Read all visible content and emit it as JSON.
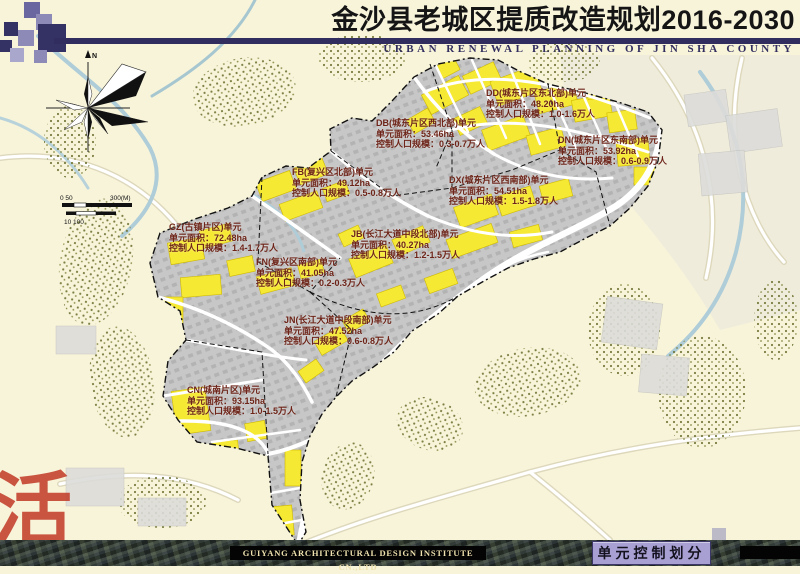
{
  "header": {
    "title": "金沙县老城区提质改造规划2016-2030",
    "subtitle": "URBAN RENEWAL PLANNING OF JIN SHA COUNTY"
  },
  "colors": {
    "accent_navy": "#312d5e",
    "highlight_yellow": "#f6e933",
    "label_text": "#6e2418",
    "tag_purple": "#a89fd2",
    "background_cream": "#f8f4da"
  },
  "compass": {
    "north_label": "N"
  },
  "scale_bar": {
    "row1_left": "0 50",
    "row1_right": "300(M)",
    "row2": "10 100"
  },
  "units": [
    {
      "id": "DD",
      "code": "DD(城东片区东北部)单元",
      "area": "单元面积：48.20ha",
      "population": "控制人口规模：1.0-1.6万人"
    },
    {
      "id": "DB",
      "code": "DB(城东片区西北部)单元",
      "area": "单元面积：53.46ha",
      "population": "控制人口规模：0.3-0.7万人"
    },
    {
      "id": "FB",
      "code": "FB(复兴区北部)单元",
      "area": "单元面积：49.12ha",
      "population": "控制人口规模：0.5-0.8万人"
    },
    {
      "id": "DX",
      "code": "DX(城东片区西南部)单元",
      "area": "单元面积：54.51ha",
      "population": "控制人口规模：1.5-1.8万人"
    },
    {
      "id": "DN",
      "code": "DN(城东片区东南部)单元",
      "area": "单元面积：53.92ha",
      "population": "控制人口规模：0.6-0.9万人"
    },
    {
      "id": "GZ",
      "code": "GZ(古镇片区)单元",
      "area": "单元面积：72.48ha",
      "population": "控制人口规模：1.4-1.7万人"
    },
    {
      "id": "FN",
      "code": "FN(复兴区南部)单元",
      "area": "单元面积：41.05ha",
      "population": "控制人口规模：0.2-0.3万人"
    },
    {
      "id": "JB",
      "code": "JB(长江大道中段北部)单元",
      "area": "单元面积：40.27ha",
      "population": "控制人口规模：1.2-1.5万人"
    },
    {
      "id": "JN",
      "code": "JN(长江大道中段南部)单元",
      "area": "单元面积：47.52ha",
      "population": "控制人口规模：0.6-0.8万人"
    },
    {
      "id": "CN",
      "code": "CN(城南片区)单元",
      "area": "单元面积：93.15ha",
      "population": "控制人口规模：1.0-1.5万人"
    }
  ],
  "watermark": {
    "character": "活"
  },
  "footer": {
    "institute": "GUIYANG ARCHITECTURAL DESIGN INSTITUTE CN.,LTD",
    "tag": "单元控制划分"
  }
}
